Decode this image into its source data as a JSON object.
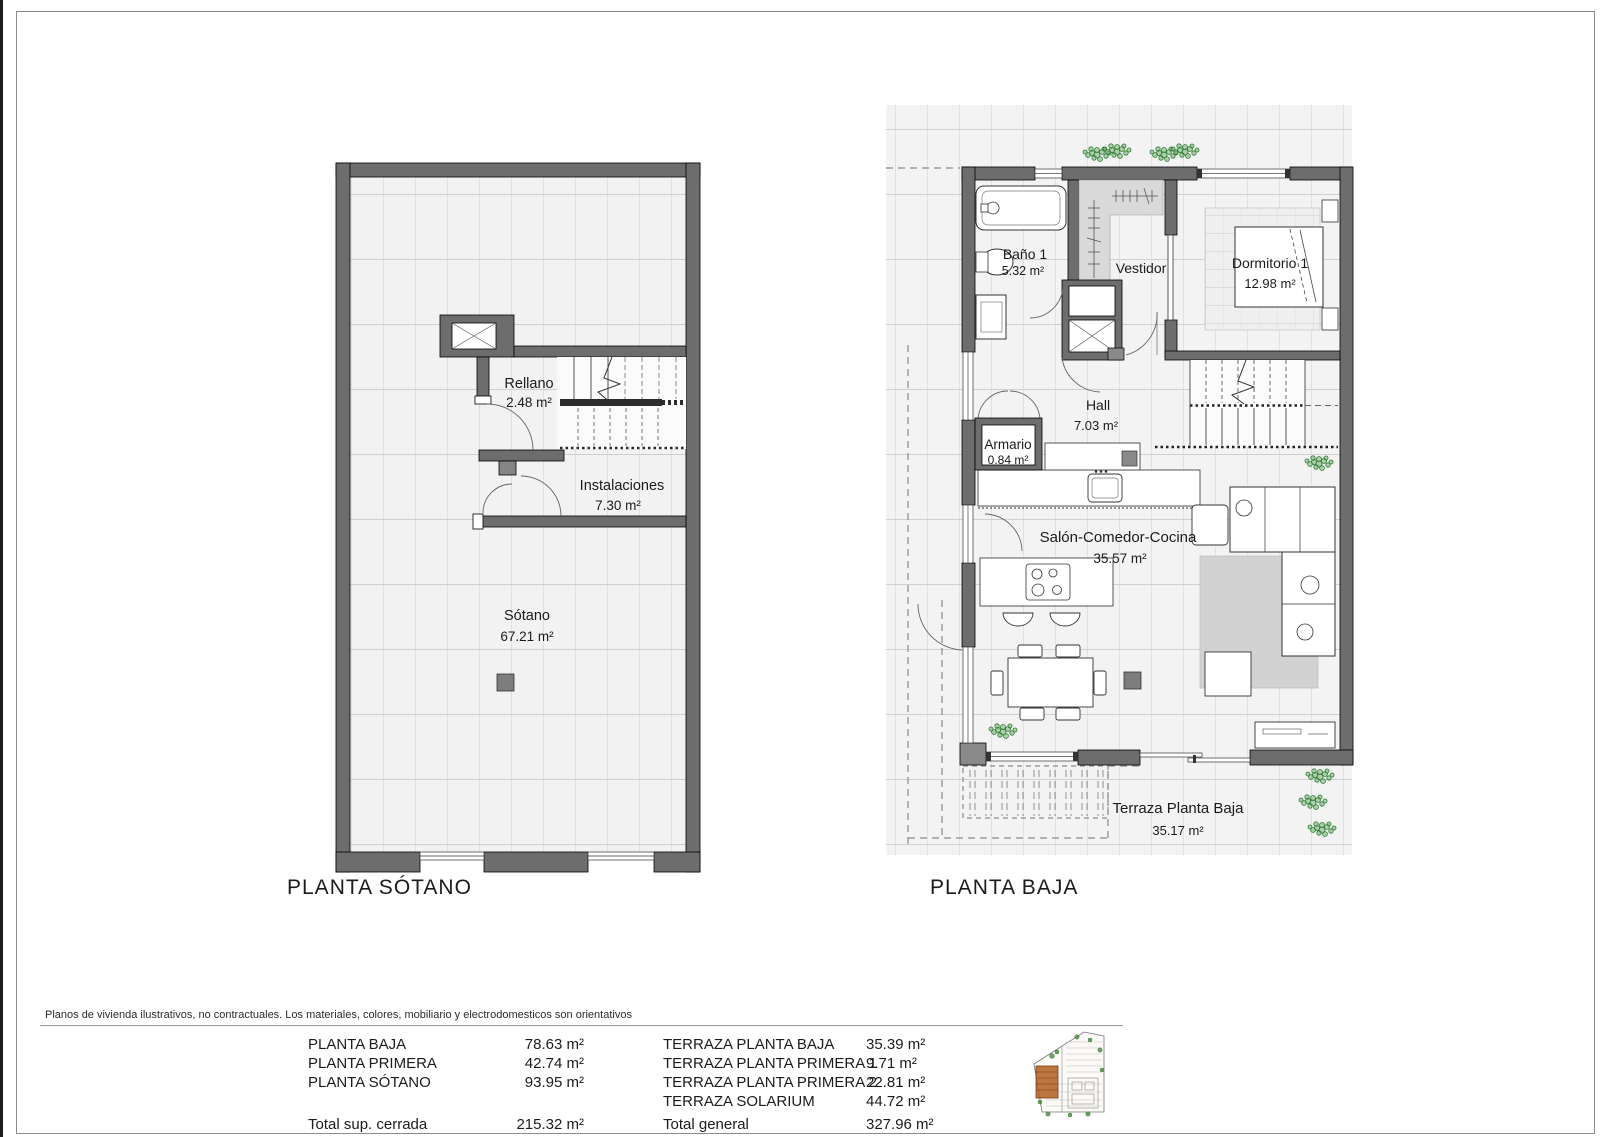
{
  "page": {
    "disclaimer": "Planos de vivienda ilustrativos, no contractuales. Los materiales, colores, mobiliario y electrodomesticos son orientativos"
  },
  "plans": {
    "sotano": {
      "title": "PLANTA SÓTANO",
      "rooms": {
        "rellano": {
          "name": "Rellano",
          "area": "2.48 m²"
        },
        "instalaciones": {
          "name": "Instalaciones",
          "area": "7.30 m²"
        },
        "sotano": {
          "name": "Sótano",
          "area": "67.21 m²"
        }
      }
    },
    "baja": {
      "title": "PLANTA BAJA",
      "rooms": {
        "bano1": {
          "name": "Baño 1",
          "area": "5.32 m²"
        },
        "vestidor": {
          "name": "Vestidor"
        },
        "dormitorio1": {
          "name": "Dormitorio 1",
          "area": "12.98 m²"
        },
        "hall": {
          "name": "Hall",
          "area": "7.03 m²"
        },
        "armario": {
          "name": "Armario",
          "area": "0.84 m²"
        },
        "salon_comedor_cocina": {
          "name": "Salón-Comedor-Cocina",
          "area": "35.57 m²"
        },
        "terraza_planta_baja": {
          "name": "Terraza Planta Baja",
          "area": "35.17 m²"
        }
      }
    }
  },
  "summary": {
    "closed_areas": {
      "rows": [
        {
          "label": "PLANTA BAJA",
          "value": "78.63 m²"
        },
        {
          "label": "PLANTA PRIMERA",
          "value": "42.74 m²"
        },
        {
          "label": "PLANTA SÓTANO",
          "value": "93.95 m²"
        }
      ],
      "total": {
        "label": "Total sup. cerrada",
        "value": "215.32 m²"
      }
    },
    "terrace_areas": {
      "rows": [
        {
          "label": "TERRAZA PLANTA BAJA",
          "value": "35.39 m²"
        },
        {
          "label": "TERRAZA PLANTA PRIMERA 1",
          "value": "9.71 m²"
        },
        {
          "label": "TERRAZA PLANTA PRIMERA 2",
          "value": "22.81 m²"
        },
        {
          "label": "TERRAZA SOLARIUM",
          "value": "44.72 m²"
        }
      ],
      "total": {
        "label": "Total general",
        "value": "327.96 m²"
      }
    }
  },
  "colors": {
    "wall": "#6d6d6d",
    "wall_dark": "#2b2b2b",
    "floor": "#f2f2f2",
    "grid_line": "#cfcfcf",
    "closet_fill": "#d9d9d9",
    "rug": "#d2d2d2",
    "plant_green": "#2e7d32",
    "site_plot": "#b05e20"
  }
}
